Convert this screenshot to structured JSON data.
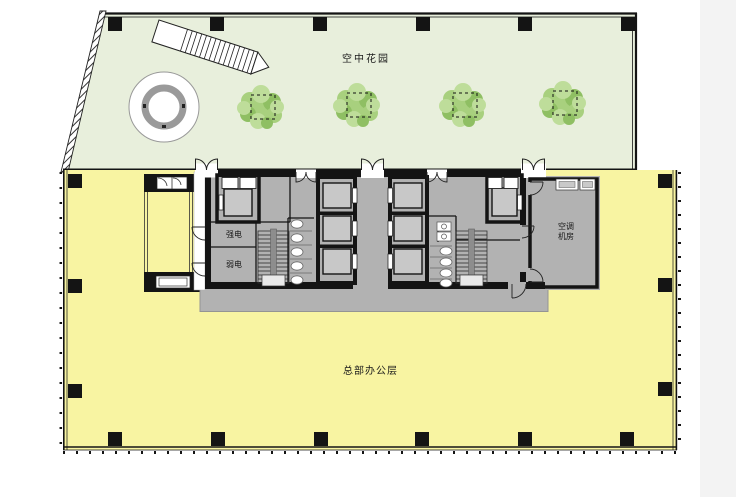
{
  "plan": {
    "labels": {
      "garden": "空中花园",
      "office": "总部办公层",
      "strong_power_room": "强电",
      "weak_power_room": "弱电",
      "ac_room_line1": "空调",
      "ac_room_line2": "机房"
    },
    "colors": {
      "background": "#ffffff",
      "garden_fill": "#e8efdc",
      "office_fill": "#f8f4a2",
      "core_fill": "#b2b2b2",
      "elevator_fill": "#c8c8c8",
      "landing_fill": "#e9e9e9",
      "tree_green": "#a8d07e",
      "tree_green_dark": "#8fbf63",
      "tree_green_light": "#bedd9a",
      "wall": "#141414",
      "stair_rail": "#8d8d8d",
      "margin_band": "#f3f3f3"
    }
  }
}
